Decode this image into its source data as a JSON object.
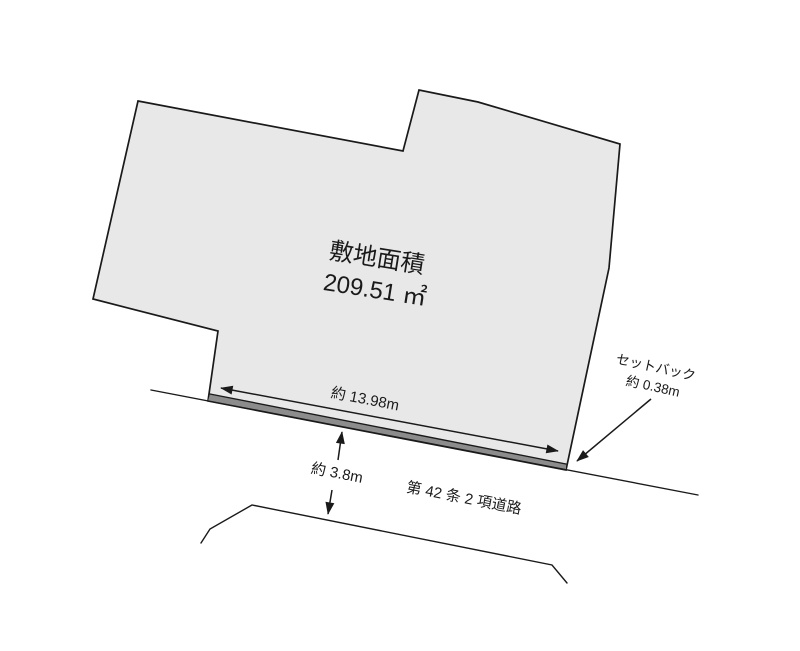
{
  "diagram": {
    "title": "敷地面積",
    "area_value": "209.51 ㎡",
    "frontage": {
      "label": "約 13.98m"
    },
    "road_width": {
      "label": "約 3.8m"
    },
    "setback": {
      "label": "セットバック",
      "value": "約 0.38m"
    },
    "road": {
      "label": "第 42 条 2 項道路"
    }
  },
  "colors": {
    "background": "#ffffff",
    "plot_fill": "#e8e8e8",
    "setback_fill": "#8c8c8c",
    "line": "#1a1a1a"
  }
}
